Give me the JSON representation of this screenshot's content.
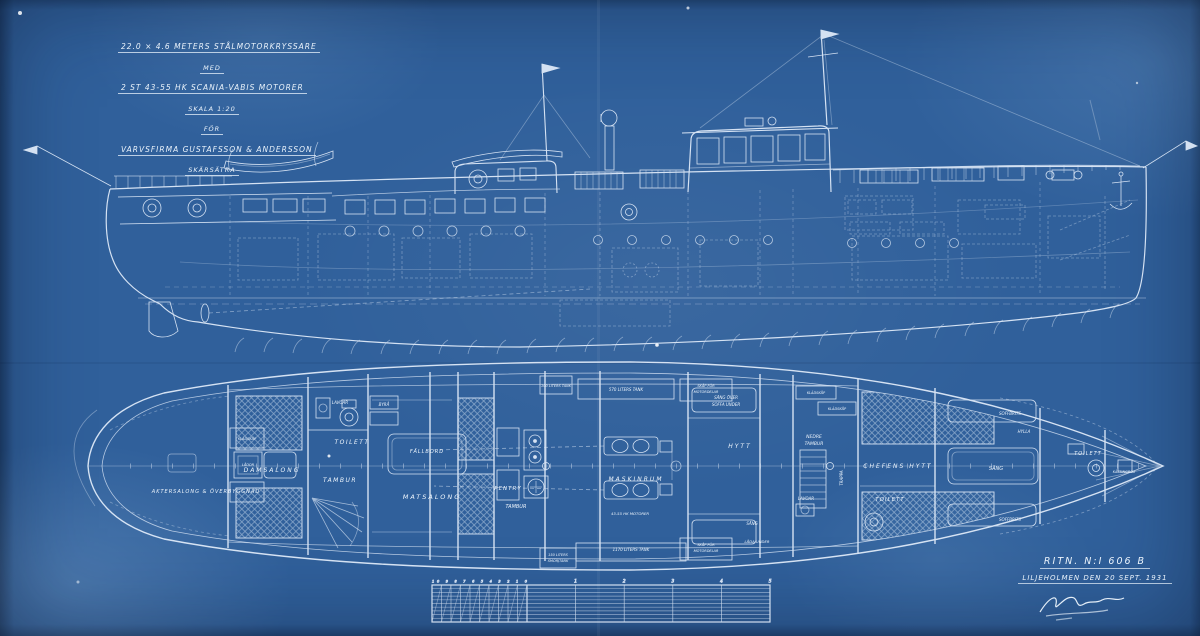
{
  "canvas": {
    "paper_color": "#30609b",
    "ink_color": "#e6f0fb"
  },
  "title_block": {
    "line1": "22.0 × 4.6 METERS STÅLMOTORKRYSSARE",
    "line2": "MED",
    "line3": "2 ST 43-55 HK SCANIA-VABIS MOTORER",
    "line4": "SKALA 1:20",
    "line5": "FÖR",
    "line6": "VARVSFIRMA GUSTAFSSON & ANDERSSON",
    "line7": "SKÄRSÄTRA"
  },
  "stamp": {
    "drawing_no": "RITN. N:I 606 B",
    "place_date": "LILJEHOLMEN DEN 20 SEPT. 1931"
  },
  "plan_labels": {
    "aktersalong": "AKTERSALONG & ÖVERBYGGNAD",
    "damsalong": "DAMSALONG",
    "kladskap_aft": "KLÄDSKÅP",
    "lador": "LÅDOR",
    "lavoar_aft": "LAVOAR",
    "toilett_aft": "TOILETT",
    "tambur_aft": "TAMBUR",
    "byra": "BYRÅ",
    "fallbord": "FÄLLBORD",
    "matsalong": "MATSALONG",
    "pentry": "PENTRY",
    "tambur_mid": "TAMBUR",
    "tank_100": "100 LITERS TANK",
    "tank_570": "570 LITERS TANK",
    "skap_top_1": "SKÅP FÖR",
    "skap_top_2": "MOTORDELAR",
    "tank_150_1": "150 LITERS",
    "tank_150_2": "SMÖRJTANK",
    "tank_1170": "1170 LITERS TANK",
    "skap_btm_1": "SKÅP FÖR",
    "skap_btm_2": "MOTORDELAR",
    "maskinrum": "MASKINRUM",
    "motorer": "43-55 HK MOTORER",
    "sang_over": "SÄNG ÖVER",
    "soffa_under": "SOFFA UNDER",
    "hytt": "HYTT",
    "sang_btm": "SÄNG",
    "lada_under": "LÅDA UNDER",
    "kladskap_1": "KLÄDSKÅP",
    "kladskap_2": "KLÄDSKÅP",
    "nedre": "NEDRE",
    "tambur_fwd": "TAMBUR",
    "trappa": "TRAPPA",
    "lavoar_mid": "LAVOAR",
    "toilett_mid": "TOILETT",
    "chefens_hytt": "CHEFENS HYTT",
    "soffbrits_top": "SOFFBRITS",
    "hylla": "HYLLA",
    "sang_mid": "SÄNG",
    "soffbrits_btm": "SOFFBRITS",
    "toilett_fwd": "TOILETT",
    "kattingbox": "KÄTTINGBOX"
  },
  "ruler": {
    "sub_digits": "10 9 8 7 6 5 4 3 2 1 0",
    "meter_marks": [
      "1",
      "2",
      "3",
      "4",
      "5"
    ]
  }
}
